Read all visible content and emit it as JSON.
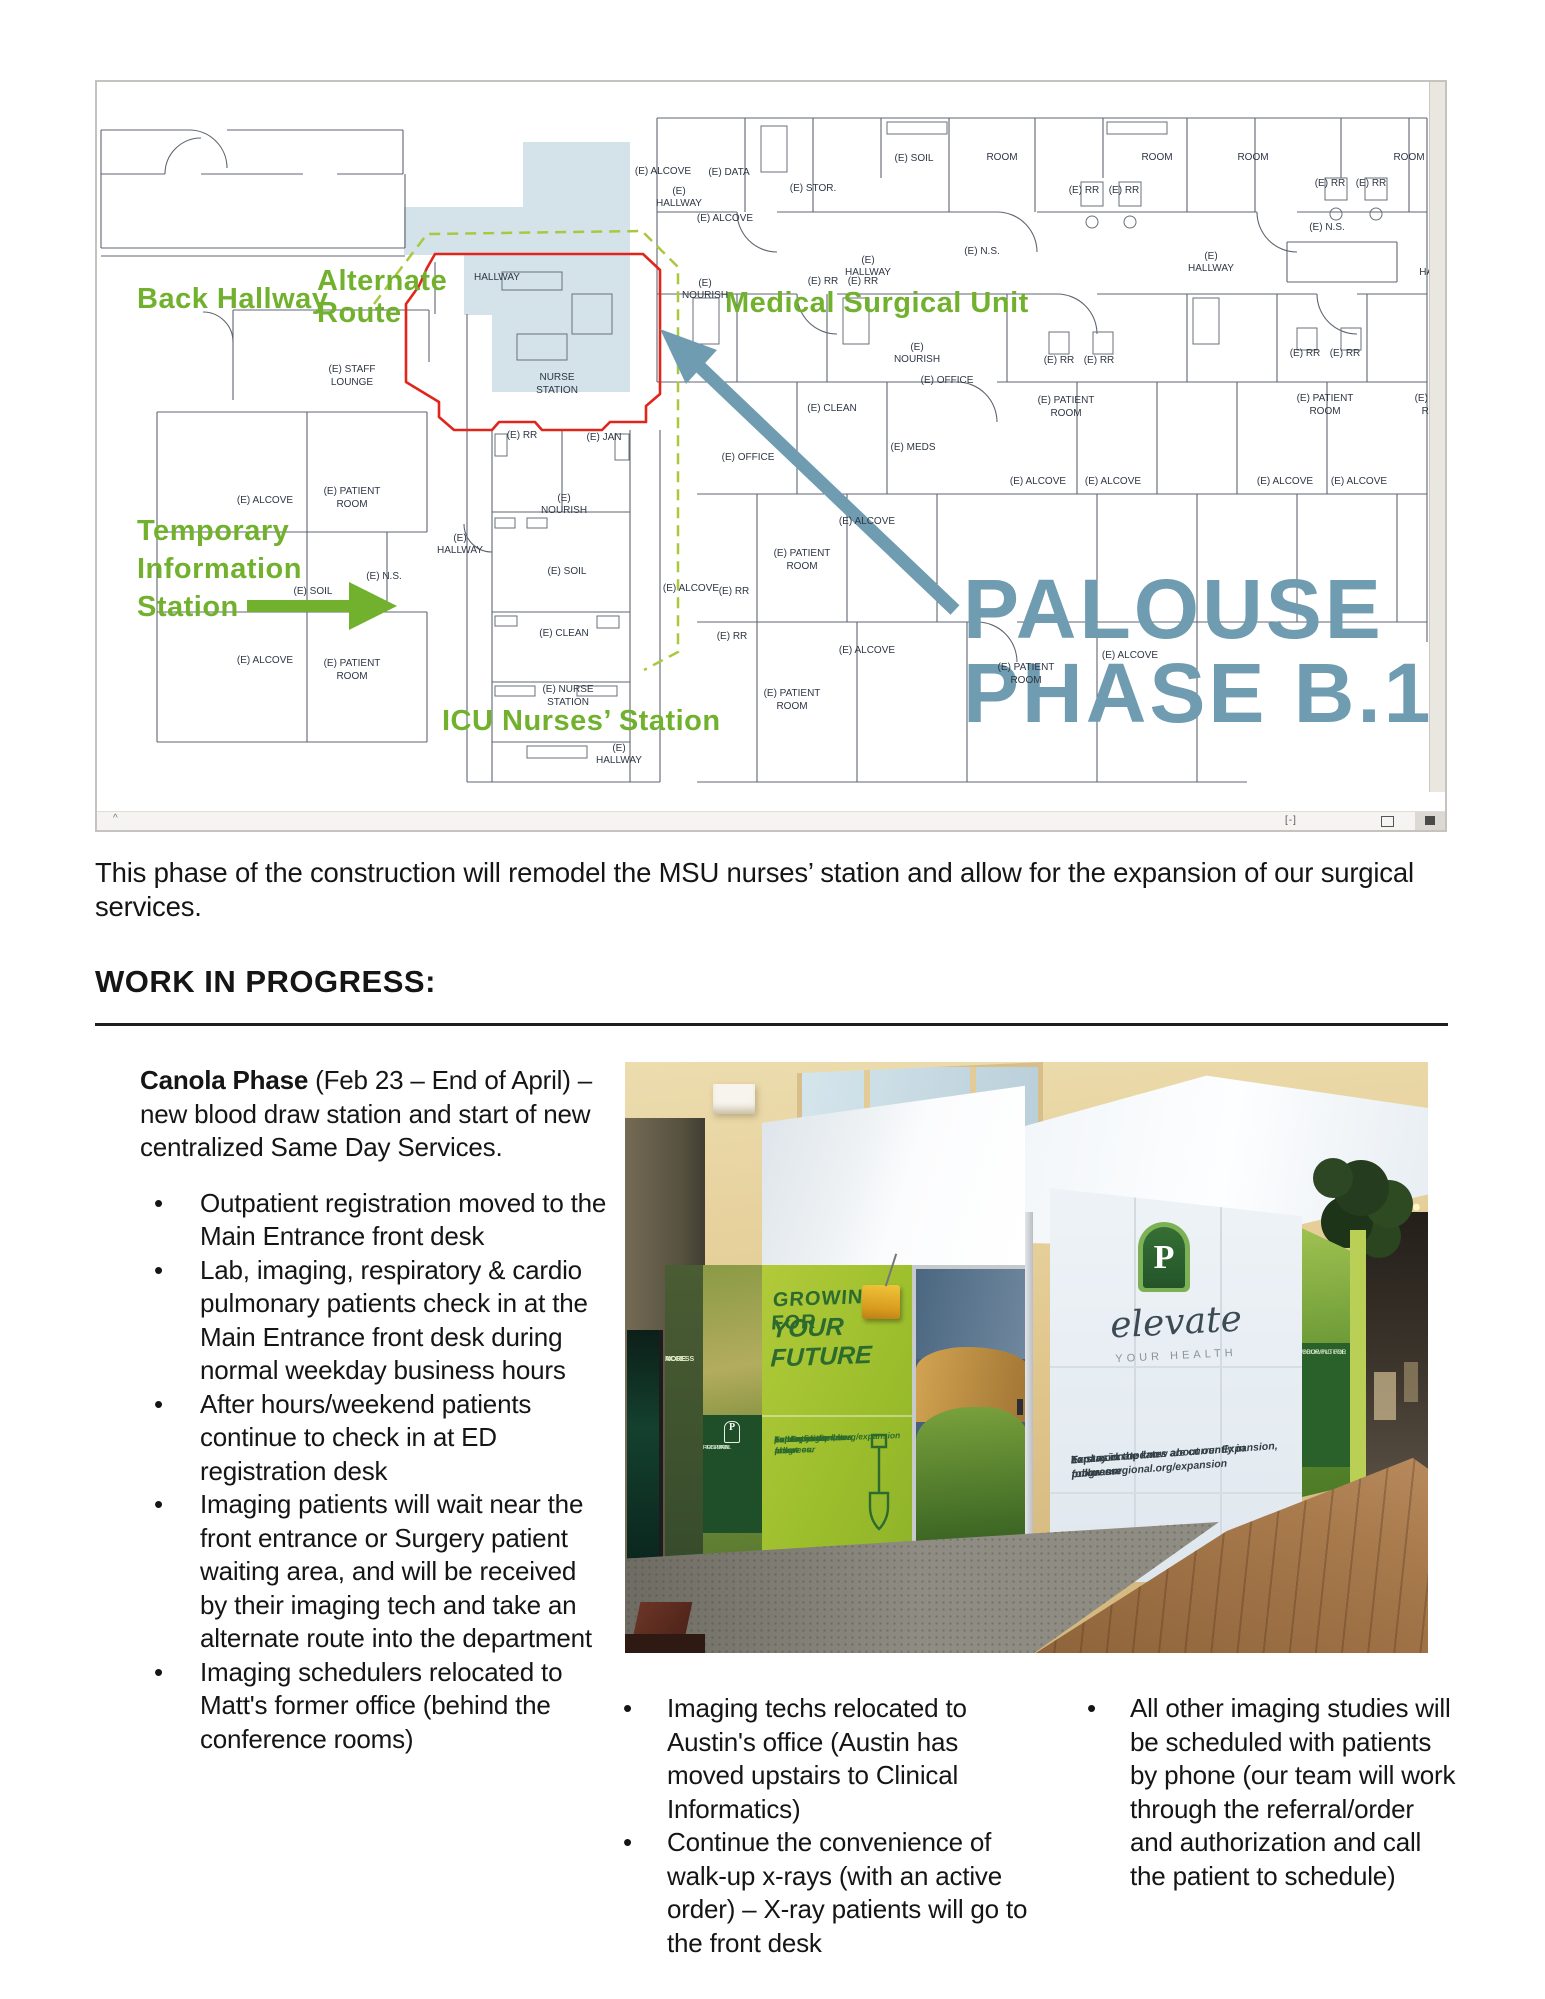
{
  "intro": {
    "text": "This phase of the construction will remodel the MSU nurses’ station and allow for the expansion of our surgical services."
  },
  "section": {
    "heading": "WORK IN PROGRESS:"
  },
  "left_column": {
    "lead_bold": "Canola Phase",
    "lead_rest": " (Feb 23 – End of April) – new blood draw station and start of new centralized Same Day Services.",
    "bullets": [
      "Outpatient registration moved to the Main Entrance front desk",
      "Lab, imaging, respiratory & cardio pulmonary patients check in at the Main Entrance front desk during normal weekday business hours",
      "After hours/weekend patients continue to check in at ED registration desk",
      "Imaging patients will wait near the front entrance or Surgery patient waiting area, and will be received by their imaging tech and take an alternate route into the department",
      "Imaging schedulers relocated to Matt's former office (behind the conference rooms)"
    ]
  },
  "bottom_columns": {
    "middle": [
      "Imaging techs relocated to Austin's office (Austin has moved upstairs to Clinical Informatics)",
      "Continue the convenience of walk-up x-rays (with an active order) – X-ray patients will go to the front desk"
    ],
    "right": [
      "All other imaging studies will be scheduled with patients by phone (our team will work through the referral/order and authorization and call the patient to schedule)"
    ]
  },
  "photo": {
    "sign_line1": "GROWING FOR",
    "sign_line2": "YOUR FUTURE",
    "sign_para": [
      "Expansion updates are",
      "currently in progress.",
      "To stay in the know about",
      "our Expansion, follow our",
      "hard work at",
      "pullmanregional.org/expansion"
    ],
    "left_panel_line1": "MORE",
    "left_panel_line2": "ACCESS",
    "mini_logo_p": "P",
    "mini_logo_lines": [
      "PULLMAN",
      "REGIONAL",
      "HOSPITAL"
    ],
    "p_letter": "P",
    "elevate_script": "elevate",
    "elevate_sub": "YOUR HEALTH",
    "elevate_para": [
      "Expansion updates are currently in progress.",
      "To stay in the know about our Expansion, follow our",
      "hard work at pullmanregional.org/expansion"
    ],
    "grass_sign_line1": "GROWING FOR",
    "grass_sign_line2": "YOUR FUTURE"
  },
  "floorplan": {
    "toolbar": {
      "caret": "^",
      "glyph1": "[-]"
    },
    "colors": {
      "green": "#72b12e",
      "blue": "#6f9cb0",
      "red": "#e1251b",
      "shade": "#ccdde6"
    },
    "labels": [
      {
        "t": "Back Hallway",
        "x": 40,
        "y": 226,
        "c": "ga",
        "n": "label-back-hallway"
      },
      {
        "t": "Alternate",
        "x": 220,
        "y": 208,
        "c": "ga",
        "n": "label-alternate-route"
      },
      {
        "t": "Route",
        "x": 220,
        "y": 240,
        "c": "ga",
        "n": "label-alternate-route"
      },
      {
        "t": "Medical Surgical Unit",
        "x": 628,
        "y": 230,
        "c": "ga",
        "n": "label-medical-surgical-unit"
      },
      {
        "t": "Temporary",
        "x": 40,
        "y": 458,
        "c": "ga",
        "n": "label-temporary-information-station"
      },
      {
        "t": "Information",
        "x": 40,
        "y": 496,
        "c": "ga",
        "n": "label-temporary-information-station"
      },
      {
        "t": "Station",
        "x": 40,
        "y": 534,
        "c": "ga",
        "n": "label-temporary-information-station"
      },
      {
        "t": "ICU Nurses’ Station",
        "x": 345,
        "y": 648,
        "c": "ga",
        "n": "label-icu-nurses-station"
      },
      {
        "t": "PALOUSE",
        "x": 866,
        "y": 556,
        "c": "bp",
        "n": "label-palouse"
      },
      {
        "t": "PHASE B.1",
        "x": 866,
        "y": 640,
        "c": "bp",
        "n": "label-phase-b1"
      },
      {
        "t": "(E) ALCOVE",
        "x": 566,
        "y": 92
      },
      {
        "t": "(E) DATA",
        "x": 632,
        "y": 93
      },
      {
        "t": "(E) STOR.",
        "x": 716,
        "y": 109
      },
      {
        "t": "(E) ALCOVE",
        "x": 628,
        "y": 139
      },
      {
        "t": "(E) SOIL",
        "x": 817,
        "y": 79
      },
      {
        "t": "ROOM",
        "x": 905,
        "y": 78
      },
      {
        "t": "ROOM",
        "x": 1060,
        "y": 78
      },
      {
        "t": "ROOM",
        "x": 1156,
        "y": 78
      },
      {
        "t": "ROOM",
        "x": 1312,
        "y": 78
      },
      {
        "t": "(E) RR",
        "x": 987,
        "y": 111
      },
      {
        "t": "(E) RR",
        "x": 1027,
        "y": 111
      },
      {
        "t": "(E) RR",
        "x": 1233,
        "y": 104
      },
      {
        "t": "(E) RR",
        "x": 1274,
        "y": 104
      },
      {
        "t": "(E)",
        "x": 582,
        "y": 112
      },
      {
        "t": "HALLWAY",
        "x": 582,
        "y": 124
      },
      {
        "t": "HALLWAY",
        "x": 400,
        "y": 198
      },
      {
        "t": "(E) N.S.",
        "x": 885,
        "y": 172
      },
      {
        "t": "(E) N.S.",
        "x": 1230,
        "y": 148
      },
      {
        "t": "(E)",
        "x": 771,
        "y": 181
      },
      {
        "t": "HALLWAY",
        "x": 771,
        "y": 193
      },
      {
        "t": "(E)",
        "x": 1114,
        "y": 177
      },
      {
        "t": "HALLWAY",
        "x": 1114,
        "y": 189
      },
      {
        "t": "HAL",
        "x": 1332,
        "y": 193
      },
      {
        "t": "(E) RR",
        "x": 726,
        "y": 202
      },
      {
        "t": "(E) RR",
        "x": 766,
        "y": 202
      },
      {
        "t": "(E) RR",
        "x": 962,
        "y": 281
      },
      {
        "t": "(E) RR",
        "x": 1002,
        "y": 281
      },
      {
        "t": "(E) RR",
        "x": 1208,
        "y": 274
      },
      {
        "t": "(E) RR",
        "x": 1248,
        "y": 274
      },
      {
        "t": "(E)",
        "x": 608,
        "y": 204
      },
      {
        "t": "NOURISH",
        "x": 608,
        "y": 216
      },
      {
        "t": "(E)",
        "x": 820,
        "y": 268
      },
      {
        "t": "NOURISH",
        "x": 820,
        "y": 280
      },
      {
        "t": "(E) OFFICE",
        "x": 850,
        "y": 301
      },
      {
        "t": "(E) OFFICE",
        "x": 651,
        "y": 378
      },
      {
        "t": "(E) CLEAN",
        "x": 735,
        "y": 329
      },
      {
        "t": "(E) PATIENT",
        "x": 969,
        "y": 321
      },
      {
        "t": "ROOM",
        "x": 969,
        "y": 334
      },
      {
        "t": "(E) PATIENT",
        "x": 1228,
        "y": 319
      },
      {
        "t": "ROOM",
        "x": 1228,
        "y": 332
      },
      {
        "t": "(E) PATI",
        "x": 1336,
        "y": 319
      },
      {
        "t": "ROO",
        "x": 1336,
        "y": 332
      },
      {
        "t": "(E) MEDS",
        "x": 816,
        "y": 368
      },
      {
        "t": "(E) ALCOVE",
        "x": 941,
        "y": 402
      },
      {
        "t": "(E) ALCOVE",
        "x": 1016,
        "y": 402
      },
      {
        "t": "(E) ALCOVE",
        "x": 1188,
        "y": 402
      },
      {
        "t": "(E) ALCOVE",
        "x": 1262,
        "y": 402
      },
      {
        "t": "(E) PATIENT",
        "x": 705,
        "y": 474
      },
      {
        "t": "ROOM",
        "x": 705,
        "y": 487
      },
      {
        "t": "(E) ALCOVE",
        "x": 770,
        "y": 442
      },
      {
        "t": "(E) ALCOVE",
        "x": 770,
        "y": 571
      },
      {
        "t": "(E) ALCOVE",
        "x": 594,
        "y": 509
      },
      {
        "t": "(E) RR",
        "x": 637,
        "y": 512
      },
      {
        "t": "(E) RR",
        "x": 635,
        "y": 557
      },
      {
        "t": "(E) PATIENT",
        "x": 695,
        "y": 614
      },
      {
        "t": "ROOM",
        "x": 695,
        "y": 627
      },
      {
        "t": "(E) PATIENT",
        "x": 929,
        "y": 588
      },
      {
        "t": "ROOM",
        "x": 929,
        "y": 601
      },
      {
        "t": "(E) ALCOVE",
        "x": 1033,
        "y": 576
      },
      {
        "t": "(E) STAFF",
        "x": 255,
        "y": 290
      },
      {
        "t": "LOUNGE",
        "x": 255,
        "y": 303
      },
      {
        "t": "(E) PATIENT",
        "x": 255,
        "y": 412
      },
      {
        "t": "ROOM",
        "x": 255,
        "y": 425
      },
      {
        "t": "(E) PATIENT",
        "x": 255,
        "y": 584
      },
      {
        "t": "ROOM",
        "x": 255,
        "y": 597
      },
      {
        "t": "(E) ALCOVE",
        "x": 168,
        "y": 421
      },
      {
        "t": "(E) ALCOVE",
        "x": 168,
        "y": 581
      },
      {
        "t": "(E) SOIL",
        "x": 216,
        "y": 512
      },
      {
        "t": "(E) N.S.",
        "x": 287,
        "y": 497
      },
      {
        "t": "(E)",
        "x": 363,
        "y": 459
      },
      {
        "t": "HALLWAY",
        "x": 363,
        "y": 471
      },
      {
        "t": "(E) RR",
        "x": 425,
        "y": 356
      },
      {
        "t": "(E) JAN",
        "x": 507,
        "y": 358
      },
      {
        "t": "(E)",
        "x": 467,
        "y": 419
      },
      {
        "t": "NOURISH",
        "x": 467,
        "y": 431
      },
      {
        "t": "(E) SOIL",
        "x": 470,
        "y": 492
      },
      {
        "t": "(E) CLEAN",
        "x": 467,
        "y": 554
      },
      {
        "t": "(E) NURSE",
        "x": 471,
        "y": 610
      },
      {
        "t": "STATION",
        "x": 471,
        "y": 623
      },
      {
        "t": "NURSE",
        "x": 460,
        "y": 298
      },
      {
        "t": "STATION",
        "x": 460,
        "y": 311
      },
      {
        "t": "(E)",
        "x": 522,
        "y": 669
      },
      {
        "t": "HALLWAY",
        "x": 522,
        "y": 681
      }
    ]
  }
}
